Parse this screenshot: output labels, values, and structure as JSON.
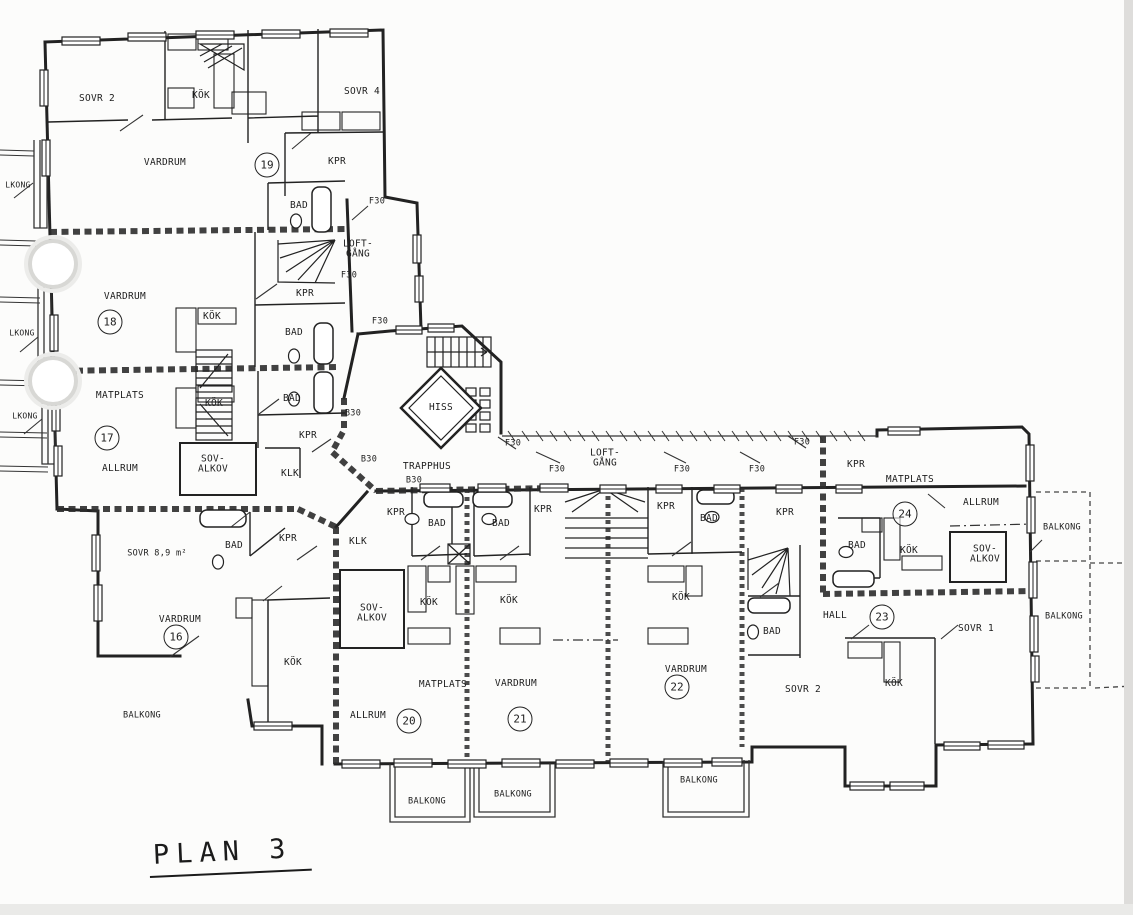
{
  "title": "PLAN 3",
  "colors": {
    "ink": "#1f1f1f",
    "paper": "#fbfbfa"
  },
  "plan": {
    "units": [
      {
        "number": "16",
        "x": 176,
        "y": 637
      },
      {
        "number": "17",
        "x": 107,
        "y": 438
      },
      {
        "number": "18",
        "x": 110,
        "y": 322
      },
      {
        "number": "19",
        "x": 267,
        "y": 165
      },
      {
        "number": "20",
        "x": 409,
        "y": 721
      },
      {
        "number": "21",
        "x": 520,
        "y": 719
      },
      {
        "number": "22",
        "x": 677,
        "y": 687
      },
      {
        "number": "23",
        "x": 882,
        "y": 617
      },
      {
        "number": "24",
        "x": 905,
        "y": 514
      }
    ],
    "labels": [
      {
        "text": "SOVR 2",
        "x": 97,
        "y": 99
      },
      {
        "text": "KÖK",
        "x": 201,
        "y": 96
      },
      {
        "text": "SOVR 4",
        "x": 362,
        "y": 92
      },
      {
        "text": "VARDRUM",
        "x": 165,
        "y": 163
      },
      {
        "text": "KPR",
        "x": 337,
        "y": 162
      },
      {
        "text": "BAD",
        "x": 299,
        "y": 206
      },
      {
        "text": "F30",
        "x": 377,
        "y": 202,
        "size": 8.5
      },
      {
        "text": "LOFT-\nGÅNG",
        "x": 358,
        "y": 250
      },
      {
        "text": "VARDRUM",
        "x": 125,
        "y": 297
      },
      {
        "text": "KÖK",
        "x": 212,
        "y": 317
      },
      {
        "text": "KPR",
        "x": 305,
        "y": 294
      },
      {
        "text": "BAD",
        "x": 294,
        "y": 333
      },
      {
        "text": "F30",
        "x": 349,
        "y": 276,
        "size": 8.5
      },
      {
        "text": "F30",
        "x": 380,
        "y": 322,
        "size": 8.5
      },
      {
        "text": "MATPLATS",
        "x": 120,
        "y": 396
      },
      {
        "text": "KÖK",
        "x": 214,
        "y": 404
      },
      {
        "text": "BAD",
        "x": 292,
        "y": 399
      },
      {
        "text": "KPR",
        "x": 308,
        "y": 436
      },
      {
        "text": "B30",
        "x": 353,
        "y": 414,
        "size": 8.5
      },
      {
        "text": "ALLRUM",
        "x": 120,
        "y": 469
      },
      {
        "text": "SOV-\nALKOV",
        "x": 213,
        "y": 465
      },
      {
        "text": "KLK",
        "x": 290,
        "y": 474
      },
      {
        "text": "B30",
        "x": 369,
        "y": 460,
        "size": 8.5
      },
      {
        "text": "TRAPPHUS",
        "x": 427,
        "y": 467
      },
      {
        "text": "B30",
        "x": 414,
        "y": 481,
        "size": 8.5
      },
      {
        "text": "HISS",
        "x": 441,
        "y": 408
      },
      {
        "text": "F30",
        "x": 513,
        "y": 444,
        "size": 8.5
      },
      {
        "text": "F30",
        "x": 557,
        "y": 470,
        "size": 8.5
      },
      {
        "text": "LOFT-\nGÅNG",
        "x": 605,
        "y": 459
      },
      {
        "text": "F30",
        "x": 682,
        "y": 470,
        "size": 8.5
      },
      {
        "text": "F30",
        "x": 757,
        "y": 470,
        "size": 8.5
      },
      {
        "text": "F30",
        "x": 802,
        "y": 443,
        "size": 8.5
      },
      {
        "text": "LKONG",
        "x": 18,
        "y": 186,
        "size": 8
      },
      {
        "text": "LKONG",
        "x": 22,
        "y": 334,
        "size": 8
      },
      {
        "text": "LKONG",
        "x": 25,
        "y": 417,
        "size": 8
      },
      {
        "text": "SOVR 8,9 m²",
        "x": 157,
        "y": 554,
        "size": 8.5
      },
      {
        "text": "BAD",
        "x": 234,
        "y": 546
      },
      {
        "text": "KPR",
        "x": 288,
        "y": 539
      },
      {
        "text": "VARDRUM",
        "x": 180,
        "y": 620
      },
      {
        "text": "KÖK",
        "x": 293,
        "y": 663
      },
      {
        "text": "BALKONG",
        "x": 142,
        "y": 716,
        "size": 8.5
      },
      {
        "text": "KLK",
        "x": 358,
        "y": 542
      },
      {
        "text": "KPR",
        "x": 396,
        "y": 513
      },
      {
        "text": "BAD",
        "x": 437,
        "y": 524
      },
      {
        "text": "BAD",
        "x": 501,
        "y": 524
      },
      {
        "text": "KPR",
        "x": 543,
        "y": 510
      },
      {
        "text": "SOV-\nALKOV",
        "x": 372,
        "y": 614
      },
      {
        "text": "KÖK",
        "x": 429,
        "y": 603
      },
      {
        "text": "KÖK",
        "x": 509,
        "y": 601
      },
      {
        "text": "MATPLATS",
        "x": 443,
        "y": 685
      },
      {
        "text": "VARDRUM",
        "x": 516,
        "y": 684
      },
      {
        "text": "ALLRUM",
        "x": 368,
        "y": 716
      },
      {
        "text": "KPR",
        "x": 666,
        "y": 507
      },
      {
        "text": "BAD",
        "x": 709,
        "y": 519
      },
      {
        "text": "KPR",
        "x": 785,
        "y": 513
      },
      {
        "text": "KÖK",
        "x": 681,
        "y": 598
      },
      {
        "text": "VARDRUM",
        "x": 686,
        "y": 670
      },
      {
        "text": "BAD",
        "x": 772,
        "y": 632
      },
      {
        "text": "SOVR 2",
        "x": 803,
        "y": 690
      },
      {
        "text": "HALL",
        "x": 835,
        "y": 616
      },
      {
        "text": "BAD",
        "x": 857,
        "y": 546
      },
      {
        "text": "KÖK",
        "x": 894,
        "y": 684
      },
      {
        "text": "SOVR 1",
        "x": 976,
        "y": 629
      },
      {
        "text": "KPR",
        "x": 856,
        "y": 465
      },
      {
        "text": "MATPLATS",
        "x": 910,
        "y": 480
      },
      {
        "text": "ALLRUM",
        "x": 981,
        "y": 503
      },
      {
        "text": "KÖK",
        "x": 909,
        "y": 551
      },
      {
        "text": "SOV-\nALKOV",
        "x": 985,
        "y": 555
      },
      {
        "text": "BALKONG",
        "x": 1062,
        "y": 528,
        "size": 8.5
      },
      {
        "text": "BALKONG",
        "x": 1064,
        "y": 617,
        "size": 8.5
      },
      {
        "text": "BALKONG",
        "x": 427,
        "y": 802,
        "size": 8.5
      },
      {
        "text": "BALKONG",
        "x": 513,
        "y": 795,
        "size": 8.5
      },
      {
        "text": "BALKONG",
        "x": 699,
        "y": 781,
        "size": 8.5
      }
    ]
  }
}
